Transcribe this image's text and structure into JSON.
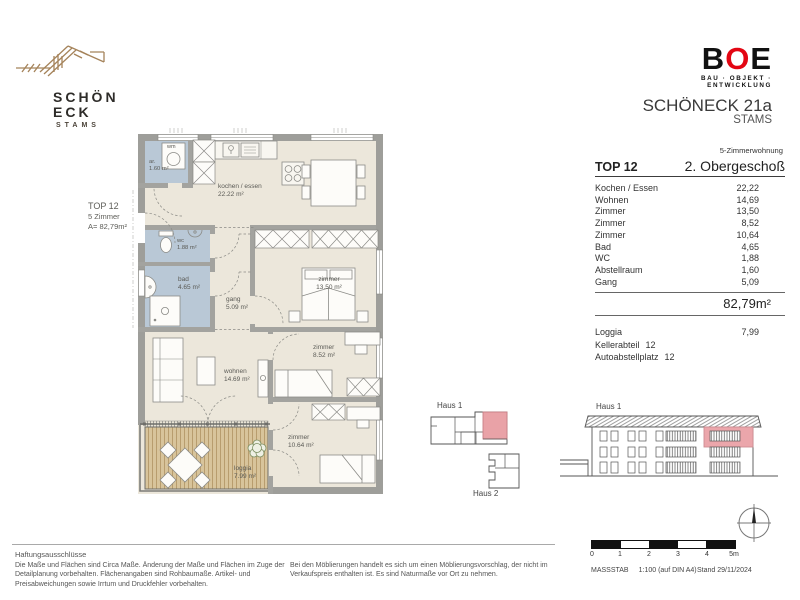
{
  "header": {
    "brand": {
      "line1": "SCHÖN",
      "line2": "ECK",
      "subtitle": "STAMS"
    },
    "developer": {
      "b": "B",
      "o": "O",
      "e": "E",
      "tagline": "BAU · OBJEKT · ENTWICKLUNG"
    },
    "project_title": "SCHÖNECK 21a",
    "project_subtitle": "STAMS"
  },
  "plan": {
    "callout": {
      "line1": "TOP 12",
      "line2": "5 Zimmer",
      "line3": "A= 82,79m²"
    },
    "rooms": {
      "abstellraum": {
        "name": "ar.",
        "area": "1.60 m²"
      },
      "kochen": {
        "name": "kochen / essen",
        "area": "22.22 m²"
      },
      "wc": {
        "name": "wc",
        "area": "1.88 m²"
      },
      "bad": {
        "name": "bad",
        "area": "4.65 m²"
      },
      "gang": {
        "name": "gang",
        "area": "5.09 m²"
      },
      "zimmer1": {
        "name": "zimmer",
        "area": "13.50 m²"
      },
      "wohnen": {
        "name": "wohnen",
        "area": "14.69 m²"
      },
      "zimmer2": {
        "name": "zimmer",
        "area": "8.52 m²"
      },
      "zimmer3": {
        "name": "zimmer",
        "area": "10.64 m²"
      },
      "loggia": {
        "name": "loggia",
        "area": "7.99 m²"
      }
    },
    "appliances": {
      "wm": "wm"
    }
  },
  "unit_table": {
    "apartment_type": "5-Zimmerwohnung",
    "unit": "TOP 12",
    "floor": "2. Obergeschoß",
    "rows": [
      {
        "label": "Kochen / Essen",
        "value": "22,22"
      },
      {
        "label": "Wohnen",
        "value": "14,69"
      },
      {
        "label": "Zimmer",
        "value": "13,50"
      },
      {
        "label": "Zimmer",
        "value": "8,52"
      },
      {
        "label": "Zimmer",
        "value": "10,64"
      },
      {
        "label": "Bad",
        "value": "4,65"
      },
      {
        "label": "WC",
        "value": "1,88"
      },
      {
        "label": "Abstellraum",
        "value": "1,60"
      },
      {
        "label": "Gang",
        "value": "5,09"
      }
    ],
    "total_area": "82,79m²",
    "loggia_row": {
      "label": "Loggia",
      "value": "7,99"
    },
    "keller_row": {
      "label": "Kellerabteil",
      "value": "12"
    },
    "parking_row": {
      "label": "Autoabstellplatz",
      "value": "12"
    }
  },
  "site_key": {
    "haus1_label": "Haus 1",
    "haus2_label": "Haus 2"
  },
  "elevation": {
    "label": "Haus 1"
  },
  "footer": {
    "disclaimer_title": "Haftungsausschlüsse",
    "disclaimer_col1": "Die Maße und Flächen sind Circa Maße. Änderung der Maße und Flächen im Zuge der Detailplanung vorbehalten. Flächenangaben sind Rohbaumaße. Artikel- und Preisabweichungen sowie Irrtum und Druckfehler vorbehalten.",
    "disclaimer_col2": "Bei den Möblierungen handelt es sich um einen Möblierungsvorschlag, der nicht im Verkaufspreis enthalten ist. Es sind Naturmaße vor Ort zu nehmen.",
    "scale_bar": {
      "ticks": [
        "0",
        "1",
        "2",
        "3",
        "4",
        "5m"
      ],
      "scale_word": "MASSSTAB",
      "scale_value": "1:100 (auf DIN A4)",
      "date_label": "Stand 29/11/2024"
    }
  },
  "colors": {
    "accent_red": "#e30613",
    "brand_gold": "#a5835a",
    "highlight_pink": "#e9a2a7",
    "wetroom_blue": "#b9c8d6",
    "floor_beige": "#ece7db",
    "wall_gray": "#9e9e9a",
    "deck_tan": "#d8c49b"
  }
}
